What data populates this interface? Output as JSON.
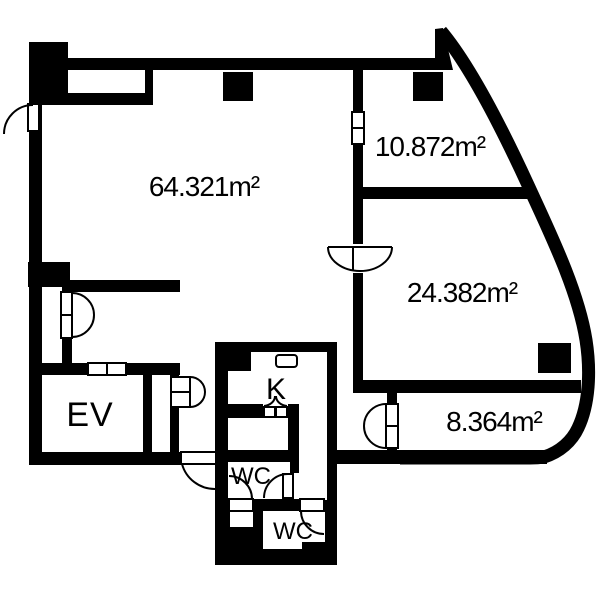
{
  "colors": {
    "wall": "#000000",
    "floor": "#ffffff"
  },
  "rooms": {
    "main": {
      "label": "64.321m²"
    },
    "upper_right": {
      "label": "10.872m²"
    },
    "middle_right": {
      "label": "24.382m²"
    },
    "lower_right": {
      "label": "8.364m²"
    },
    "elevator": {
      "label": "EV"
    },
    "kitchen": {
      "label": "K"
    },
    "wc_upper": {
      "label": "WC"
    },
    "wc_lower": {
      "label": "WC"
    }
  }
}
